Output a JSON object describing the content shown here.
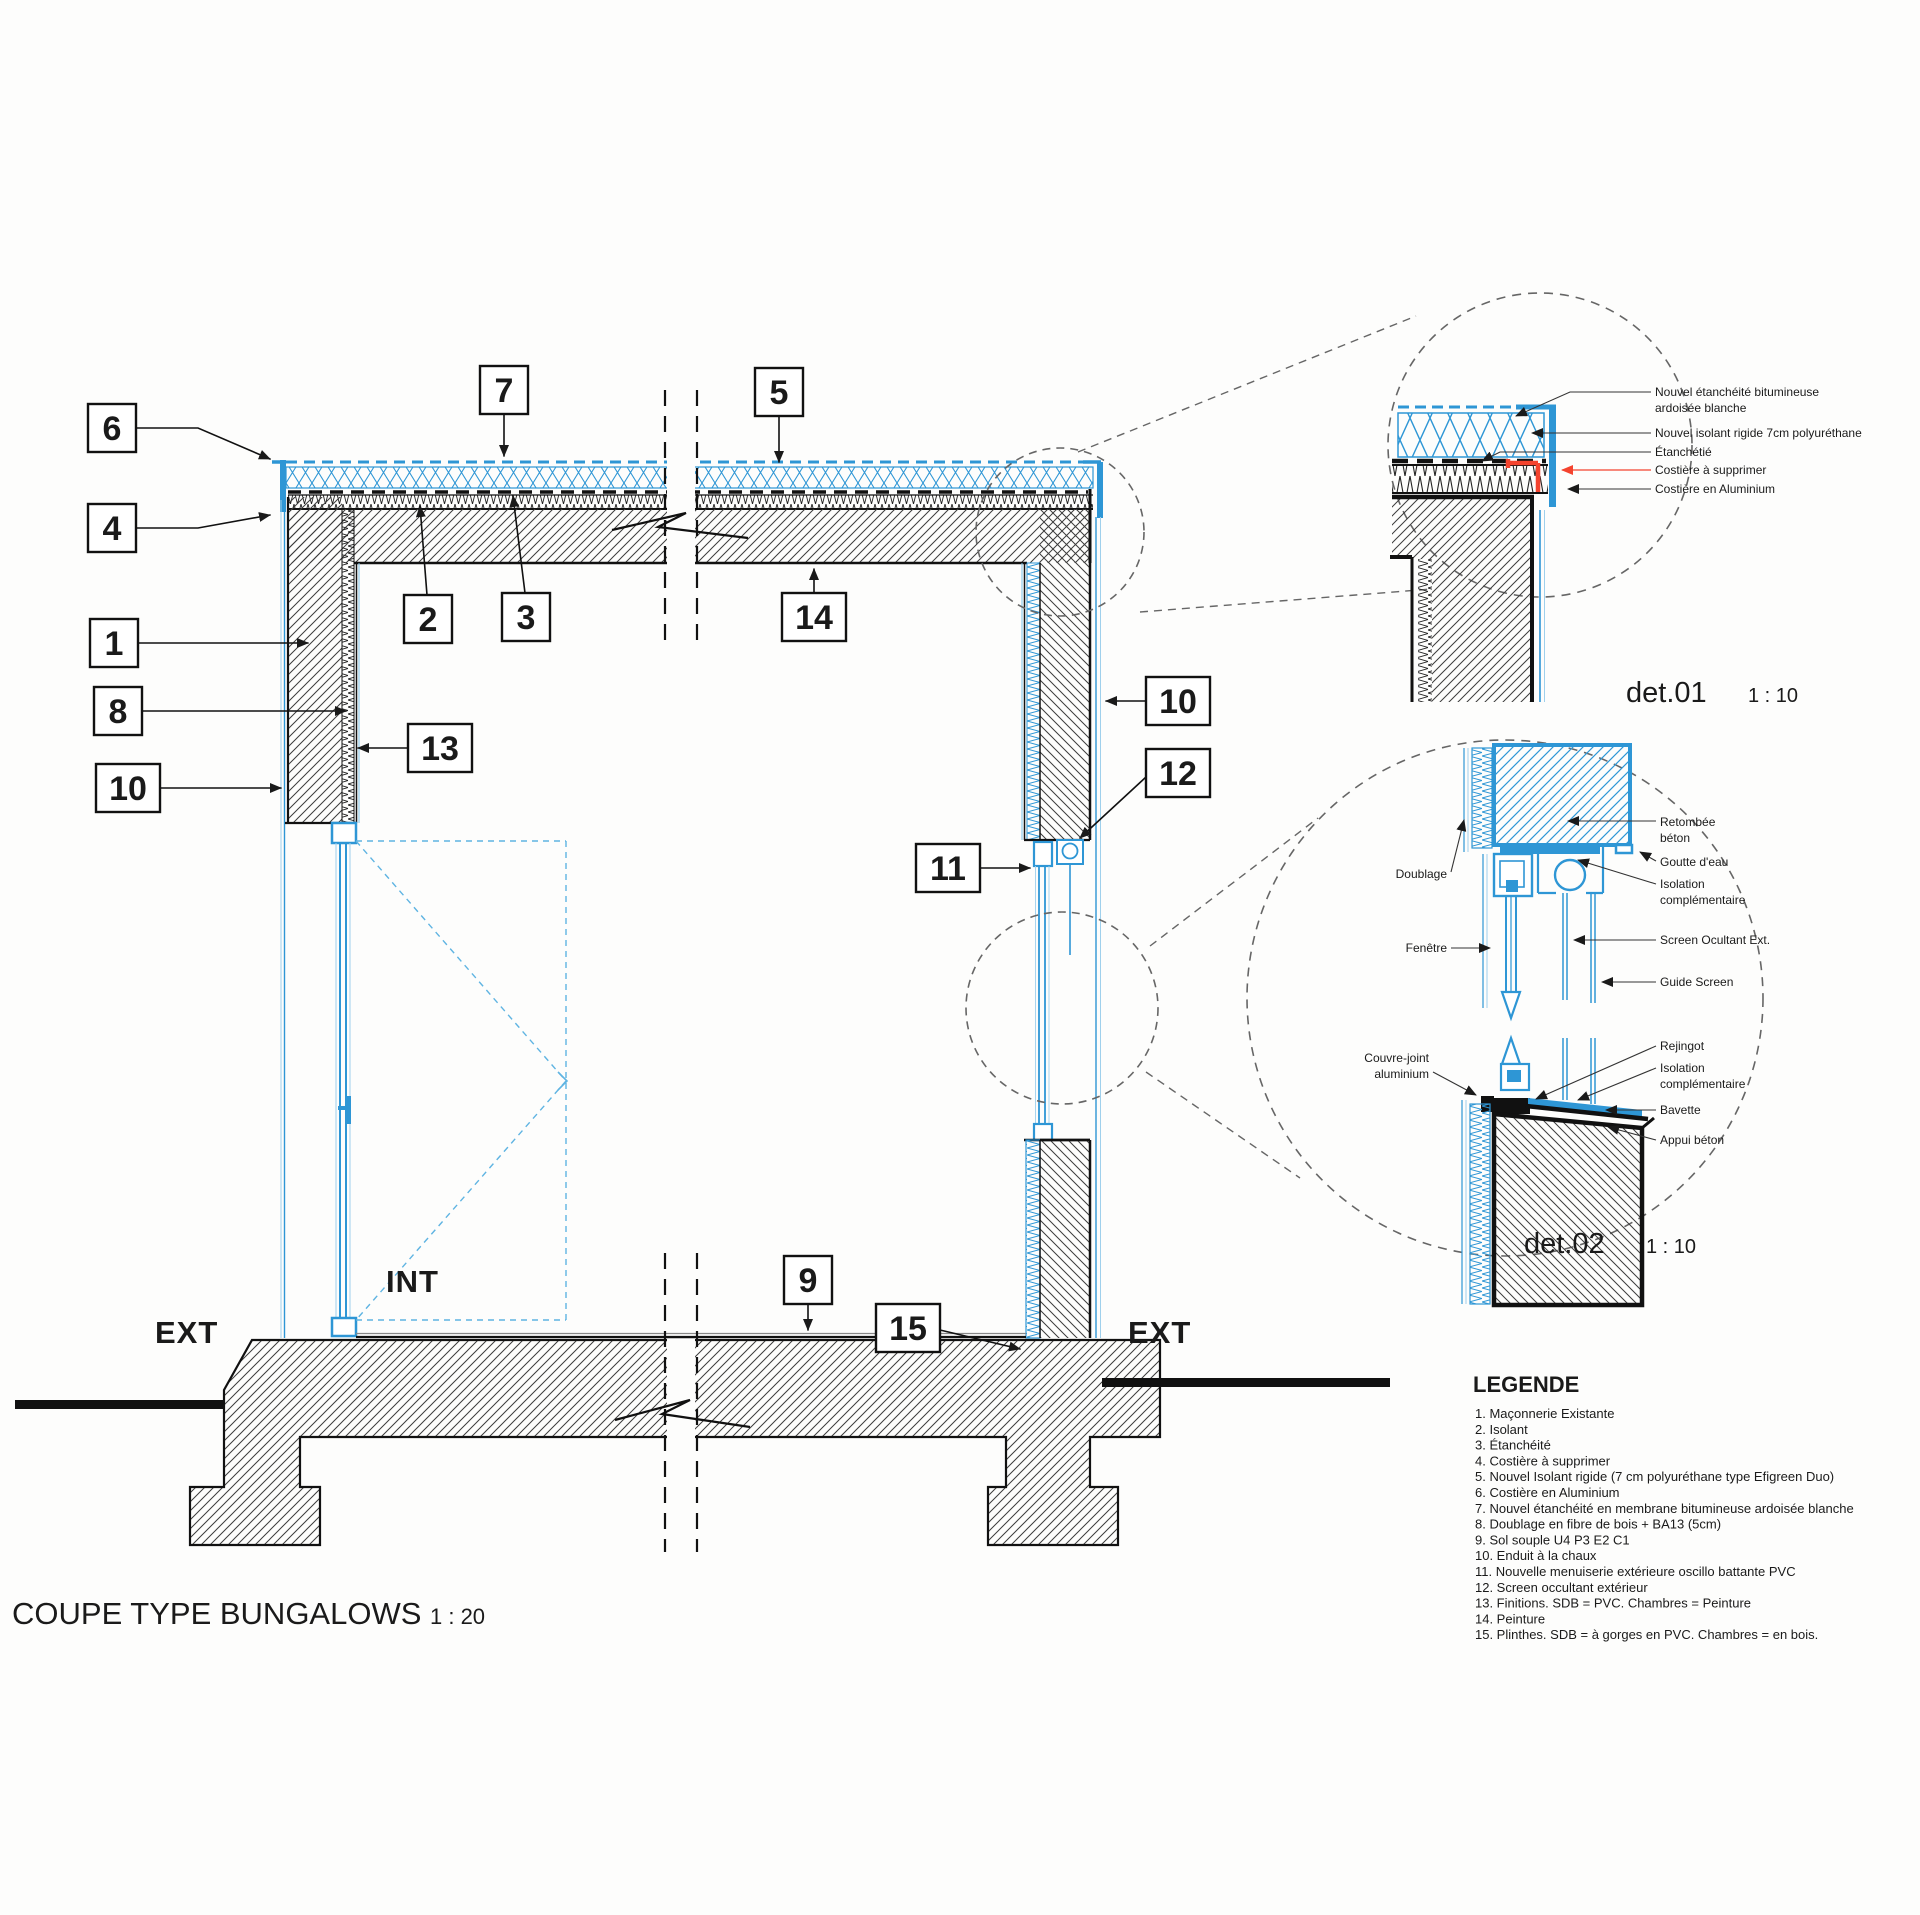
{
  "colors": {
    "blue": "#2e96d5",
    "light_blue": "#9fd0ec",
    "swing_blue": "#5fb4e2",
    "red": "#f4432e",
    "black": "#1a1a1a",
    "dash_gray": "#666666"
  },
  "main": {
    "title": "COUPE TYPE BUNGALOWS",
    "scale": "1 : 20",
    "ext_left": "EXT",
    "int_label": "INT",
    "ext_right": "EXT",
    "callouts": {
      "n1": "1",
      "n2": "2",
      "n3": "3",
      "n4": "4",
      "n5": "5",
      "n6": "6",
      "n7": "7",
      "n8": "8",
      "n9": "9",
      "n10": "10",
      "n11": "11",
      "n12": "12",
      "n13": "13",
      "n14": "14",
      "n15": "15"
    }
  },
  "det01": {
    "title": "det.01",
    "scale": "1 : 10",
    "labels": {
      "membrane_1": "Nouvel étanchéité bitumineuse",
      "membrane_2": "ardoisée blanche",
      "isolant": "Nouvel isolant rigide 7cm polyuréthane",
      "etancheite": "Étanchétié",
      "costiere_supprimer": "Costière à supprimer",
      "costiere_alu": "Costière en Aluminium"
    }
  },
  "det02": {
    "title": "det.02",
    "scale": "1 : 10",
    "labels": {
      "doublage": "Doublage",
      "fenetre": "Fenêtre",
      "couvre_joint_1": "Couvre-joint",
      "couvre_joint_2": "aluminium",
      "retombee_1": "Retombée",
      "retombee_2": "béton",
      "goutte_eau": "Goutte d'eau",
      "isolation_1a": "Isolation",
      "isolation_1b": "complémentaire",
      "screen": "Screen Ocultant Ext.",
      "guide_screen": "Guide Screen",
      "rejingot": "Rejingot",
      "isolation_2a": "Isolation",
      "isolation_2b": "complémentaire",
      "bavette": "Bavette",
      "appui": "Appui béton"
    }
  },
  "legend": {
    "title": "LEGENDE",
    "items": [
      "1. Maçonnerie Existante",
      "2. Isolant",
      "3. Étanchéité",
      "4. Costière à supprimer",
      "5. Nouvel Isolant rigide (7 cm polyuréthane type Efigreen Duo)",
      "6. Costière en Aluminium",
      "7. Nouvel étanchéité en membrane bitumineuse ardoisée blanche",
      "8. Doublage en fibre de bois + BA13 (5cm)",
      "9. Sol souple U4 P3 E2 C1",
      "10. Enduit à la chaux",
      "11. Nouvelle menuiserie extérieure oscillo battante PVC",
      "12. Screen occultant extérieur",
      "13. Finitions. SDB = PVC. Chambres = Peinture",
      "14. Peinture",
      "15. Plinthes. SDB = à gorges en PVC. Chambres = en bois."
    ]
  }
}
